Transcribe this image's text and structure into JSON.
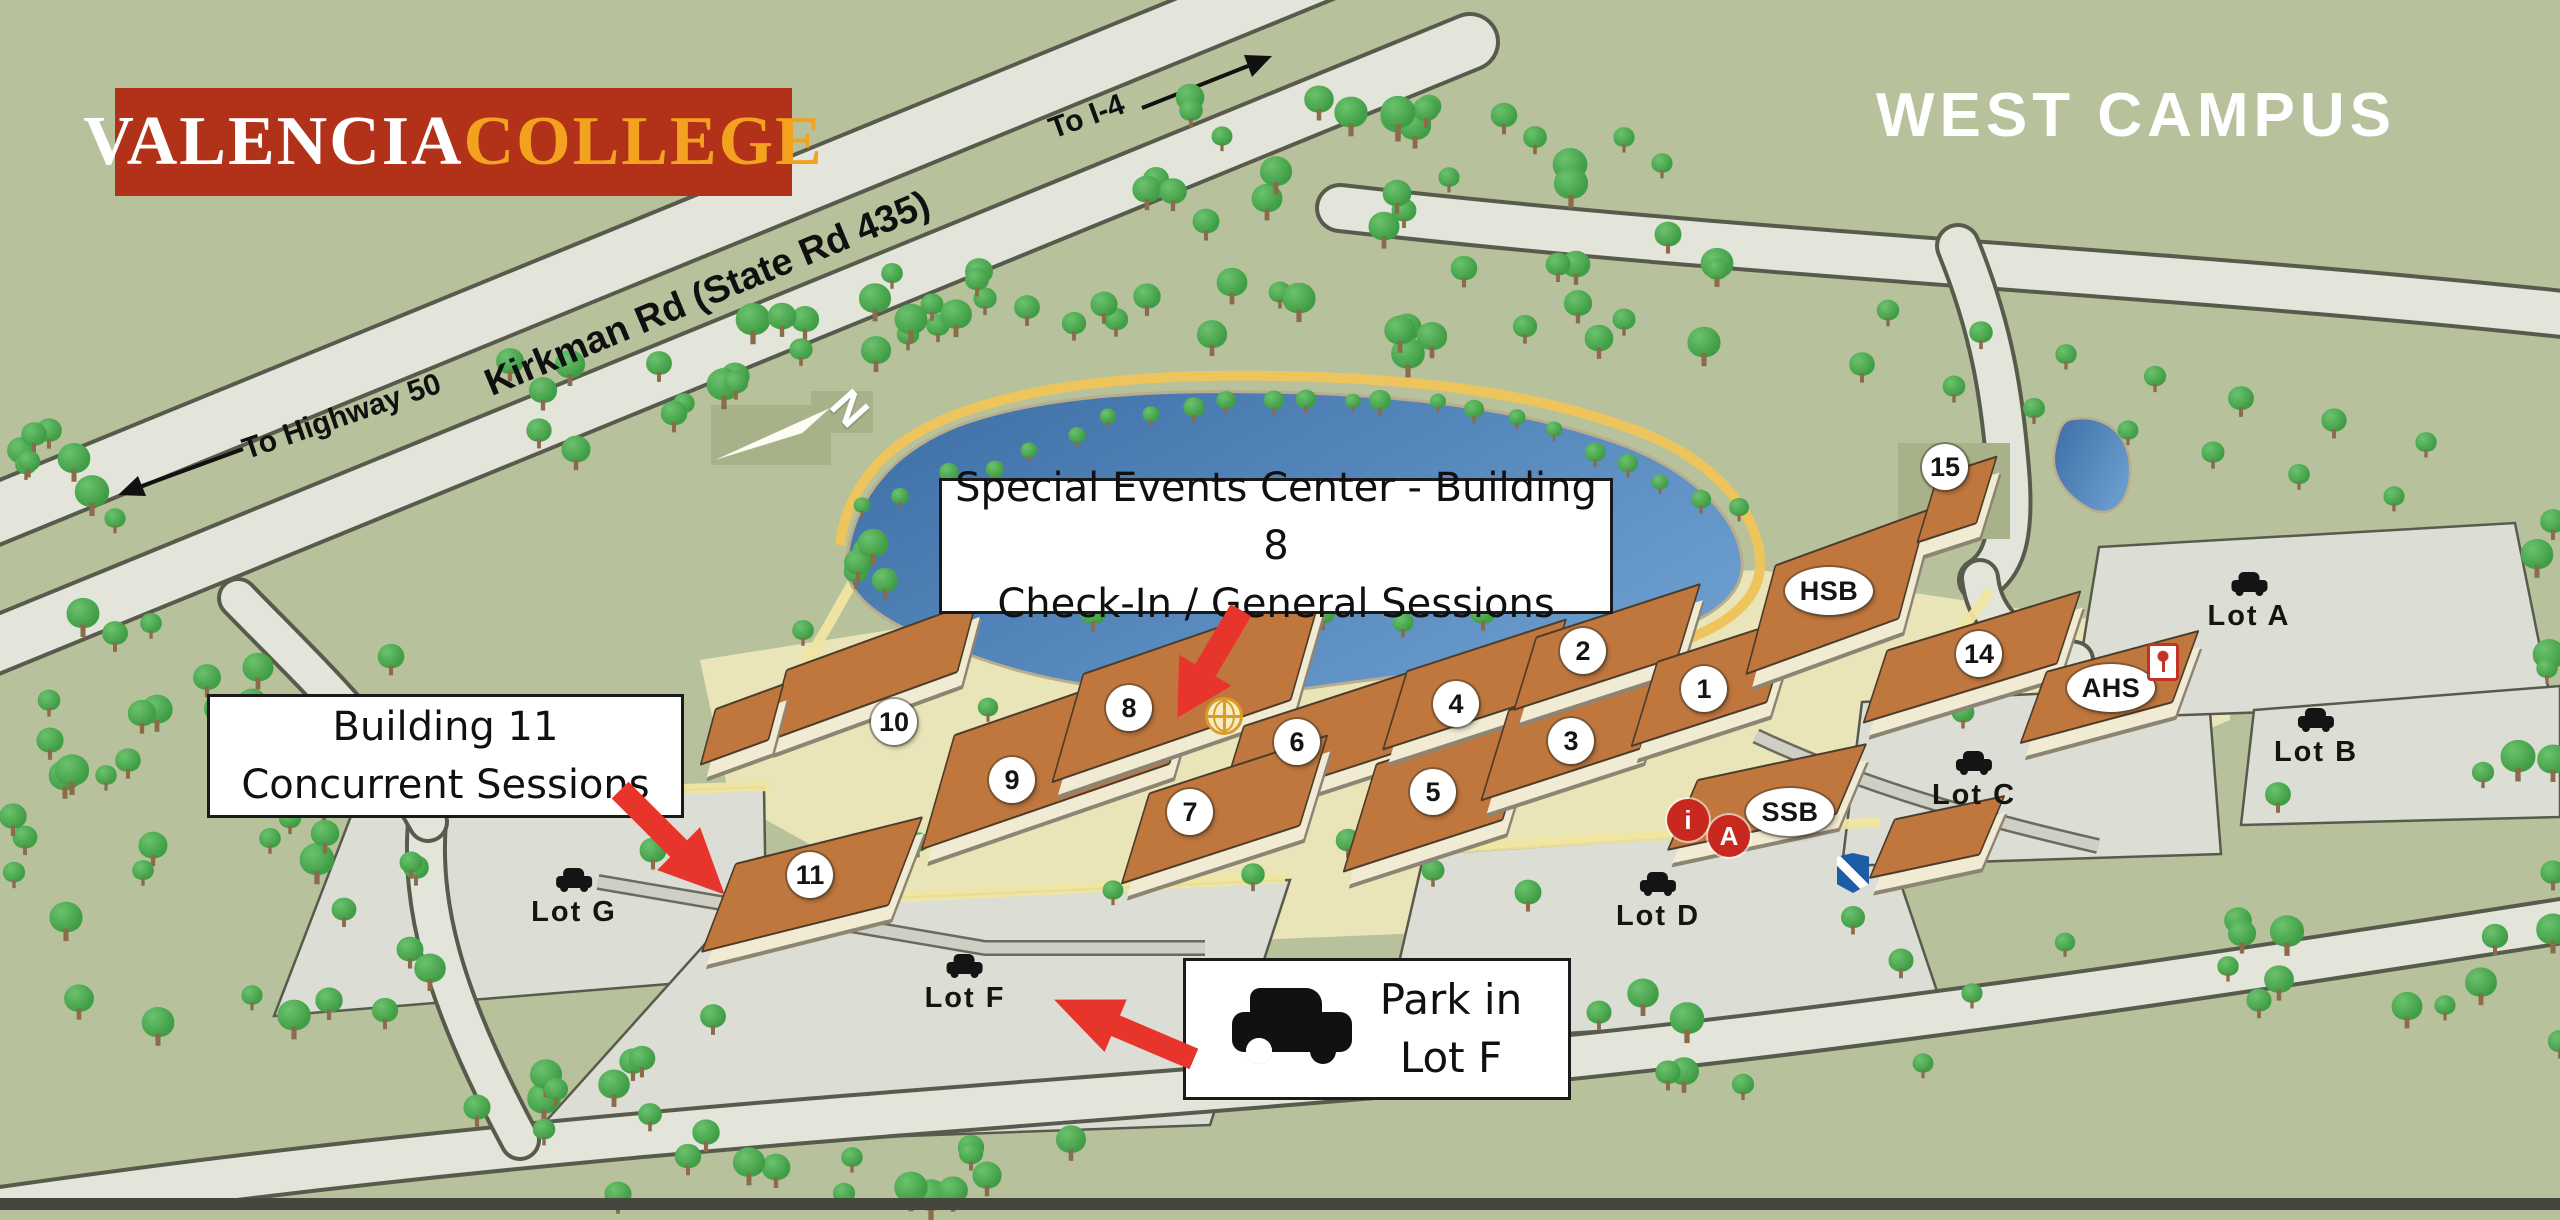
{
  "title": "WEST CAMPUS",
  "logo": {
    "part1": "VALENCIA",
    "part2": "COLLEGE"
  },
  "roads": {
    "kirkman": "Kirkman Rd (State Rd 435)",
    "to_i4": "To I-4",
    "to_highway_50": "To Highway 50"
  },
  "compass": {
    "north": "N"
  },
  "callouts": {
    "special_events": {
      "line1": "Special Events Center - Building 8",
      "line2": "Check-In / General Sessions"
    },
    "building11": {
      "line1": "Building 11",
      "line2": "Concurrent Sessions"
    },
    "parking": {
      "line1": "Park in",
      "line2": "Lot F"
    }
  },
  "building_badges": [
    "1",
    "2",
    "3",
    "4",
    "5",
    "6",
    "7",
    "8",
    "9",
    "10",
    "11",
    "14",
    "15"
  ],
  "building_ovals": [
    "HSB",
    "AHS",
    "SSB"
  ],
  "parking_lots": [
    "Lot A",
    "Lot B",
    "Lot C",
    "Lot D",
    "Lot F",
    "Lot G"
  ],
  "map_icons": {
    "info_label": "i",
    "accessibility_label": "A"
  },
  "colors": {
    "background": "#b7c29c",
    "road": "#e3e4da",
    "parking_lot": "#dcded5",
    "lake": "#4d7fb3",
    "shore_path": "#eec45c",
    "tree": "#4ba84f",
    "roof": "#c0773e",
    "wall": "#f2ebd4",
    "accent_red": "#e8352b",
    "badge_red": "#c8281d",
    "security_blue": "#1d5ca6",
    "logo_red": "#b23119",
    "logo_gold": "#f3a21f"
  }
}
